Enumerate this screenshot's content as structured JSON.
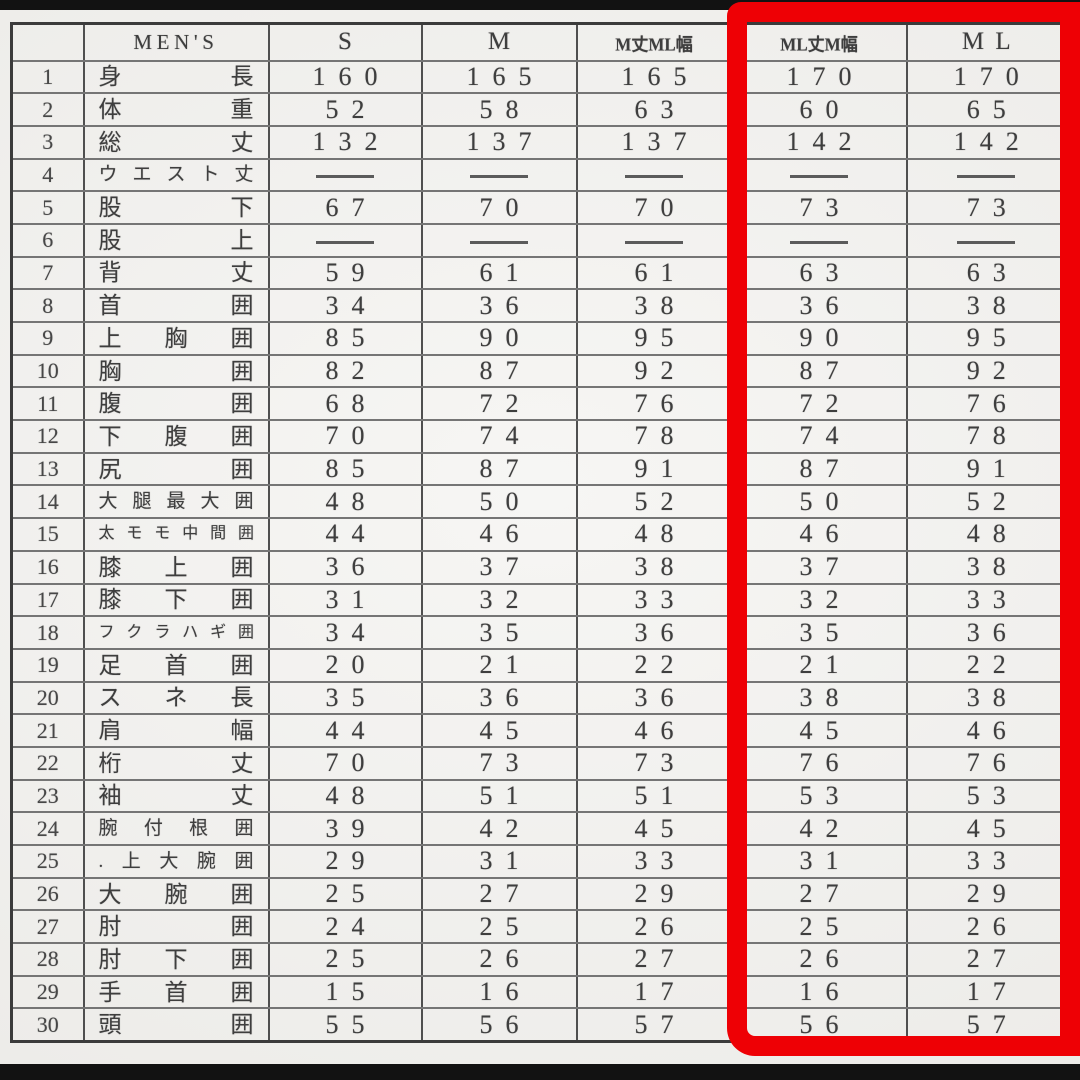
{
  "document": {
    "type": "scanned-size-chart",
    "units_note": "",
    "brand_header": "MEN'S"
  },
  "colors": {
    "highlight_red": "#ee0005",
    "paper": "#f2f1ee",
    "ink": "#3e3e3e",
    "letterbox_bar": "#121212"
  },
  "table": {
    "columns": [
      {
        "key": "num",
        "label": "",
        "style": "empty"
      },
      {
        "key": "name",
        "label": "MEN'S",
        "style": "brand"
      },
      {
        "key": "s",
        "label": "S",
        "style": "size"
      },
      {
        "key": "m",
        "label": "M",
        "style": "size"
      },
      {
        "key": "m_ml",
        "label": "M丈ML幅",
        "style": "combo"
      },
      {
        "key": "ml_m",
        "label": "ML丈M幅",
        "style": "combo"
      },
      {
        "key": "ml",
        "label": "ML",
        "style": "size"
      }
    ],
    "highlighted_columns": [
      "ML丈M幅",
      "ML"
    ],
    "rows": [
      {
        "num": "1",
        "name": "身長",
        "values": [
          "160",
          "165",
          "165",
          "170",
          "170"
        ]
      },
      {
        "num": "2",
        "name": "体重",
        "values": [
          "52",
          "58",
          "63",
          "60",
          "65"
        ]
      },
      {
        "num": "3",
        "name": "総丈",
        "values": [
          "132",
          "137",
          "137",
          "142",
          "142"
        ]
      },
      {
        "num": "4",
        "name": "ウエスト丈",
        "values": [
          "———",
          "———",
          "———",
          "———",
          "———"
        ]
      },
      {
        "num": "5",
        "name": "股下",
        "values": [
          "67",
          "70",
          "70",
          "73",
          "73"
        ]
      },
      {
        "num": "6",
        "name": "股上",
        "values": [
          "———",
          "———",
          "———",
          "———",
          "———"
        ]
      },
      {
        "num": "7",
        "name": "背丈",
        "values": [
          "59",
          "61",
          "61",
          "63",
          "63"
        ]
      },
      {
        "num": "8",
        "name": "首囲",
        "values": [
          "34",
          "36",
          "38",
          "36",
          "38"
        ]
      },
      {
        "num": "9",
        "name": "上胸囲",
        "values": [
          "85",
          "90",
          "95",
          "90",
          "95"
        ]
      },
      {
        "num": "10",
        "name": "胸囲",
        "values": [
          "82",
          "87",
          "92",
          "87",
          "92"
        ]
      },
      {
        "num": "11",
        "name": "腹囲",
        "values": [
          "68",
          "72",
          "76",
          "72",
          "76"
        ]
      },
      {
        "num": "12",
        "name": "下腹囲",
        "values": [
          "70",
          "74",
          "78",
          "74",
          "78"
        ]
      },
      {
        "num": "13",
        "name": "尻囲",
        "values": [
          "85",
          "87",
          "91",
          "87",
          "91"
        ]
      },
      {
        "num": "14",
        "name": "大腿最大囲",
        "values": [
          "48",
          "50",
          "52",
          "50",
          "52"
        ]
      },
      {
        "num": "15",
        "name": "太モモ中間囲",
        "values": [
          "44",
          "46",
          "48",
          "46",
          "48"
        ]
      },
      {
        "num": "16",
        "name": "膝上囲",
        "values": [
          "36",
          "37",
          "38",
          "37",
          "38"
        ]
      },
      {
        "num": "17",
        "name": "膝下囲",
        "values": [
          "31",
          "32",
          "33",
          "32",
          "33"
        ]
      },
      {
        "num": "18",
        "name": "フクラハギ囲",
        "values": [
          "34",
          "35",
          "36",
          "35",
          "36"
        ]
      },
      {
        "num": "19",
        "name": "足首囲",
        "values": [
          "20",
          "21",
          "22",
          "21",
          "22"
        ]
      },
      {
        "num": "20",
        "name": "スネ長",
        "values": [
          "35",
          "36",
          "36",
          "38",
          "38"
        ]
      },
      {
        "num": "21",
        "name": "肩幅",
        "values": [
          "44",
          "45",
          "46",
          "45",
          "46"
        ]
      },
      {
        "num": "22",
        "name": "桁丈",
        "values": [
          "70",
          "73",
          "73",
          "76",
          "76"
        ]
      },
      {
        "num": "23",
        "name": "袖丈",
        "values": [
          "48",
          "51",
          "51",
          "53",
          "53"
        ]
      },
      {
        "num": "24",
        "name": "腕付根囲",
        "values": [
          "39",
          "42",
          "45",
          "42",
          "45"
        ]
      },
      {
        "num": "25",
        "name": ".上大腕囲",
        "values": [
          "29",
          "31",
          "33",
          "31",
          "33"
        ]
      },
      {
        "num": "26",
        "name": "大腕囲",
        "values": [
          "25",
          "27",
          "29",
          "27",
          "29"
        ]
      },
      {
        "num": "27",
        "name": "肘囲",
        "values": [
          "24",
          "25",
          "26",
          "25",
          "26"
        ]
      },
      {
        "num": "28",
        "name": "肘下囲",
        "values": [
          "25",
          "26",
          "27",
          "26",
          "27"
        ]
      },
      {
        "num": "29",
        "name": "手首囲",
        "values": [
          "15",
          "16",
          "17",
          "16",
          "17"
        ]
      },
      {
        "num": "30",
        "name": "頭囲",
        "values": [
          "55",
          "56",
          "57",
          "56",
          "57"
        ]
      }
    ]
  }
}
